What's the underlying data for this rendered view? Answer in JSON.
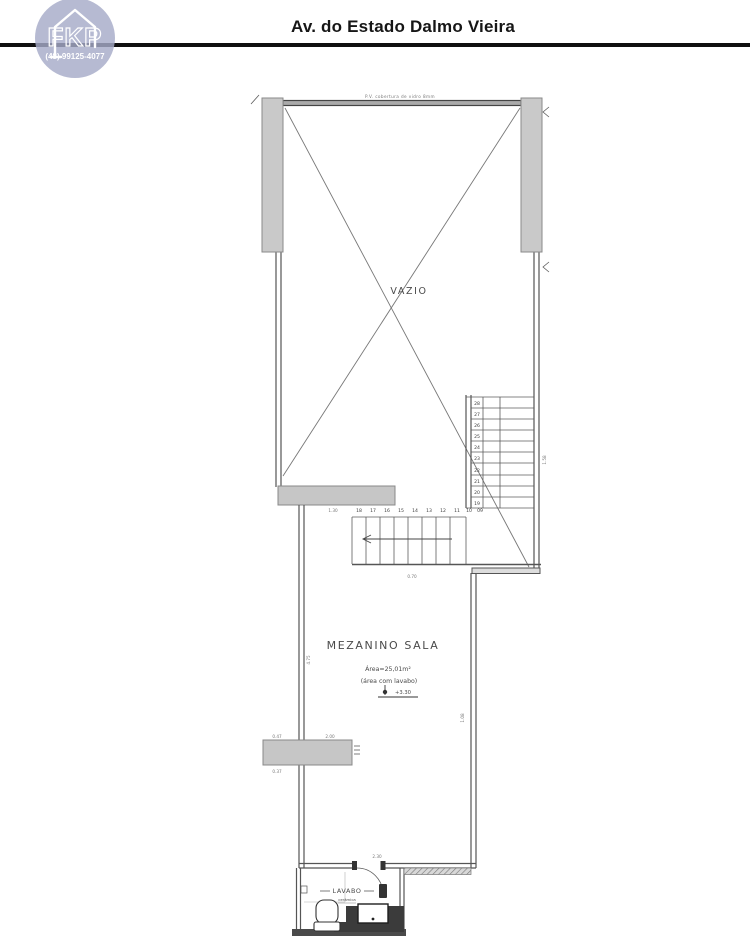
{
  "header": {
    "title": "Av. do Estado Dalmo Vieira",
    "logo": {
      "text": "FKP",
      "phone": "(48) 99125-4077",
      "color": "#a6abc8"
    }
  },
  "plan": {
    "labels": {
      "top_note": "P.V. cobertura de vidro 8mm",
      "vazio": "VAZIO",
      "room": "MEZANINO SALA",
      "area": "Área=25,01m²",
      "area_note": "(área com lavabo)",
      "level": "+3.30",
      "lavabo": "LAVABO",
      "lavabo_note": "cerâmica"
    },
    "dims": {
      "stair_run": "1.30",
      "stair_bottom": "0.70",
      "door": "2.30",
      "sill_top_left": "0.47",
      "sill_top_right": "2.00",
      "sill_bottom_left": "0.37",
      "right_wall": "1.58",
      "mezz_right_wall": "1.08",
      "mezz_left_wall": "4.75"
    },
    "stairs": {
      "vertical": [
        "28",
        "27",
        "26",
        "25",
        "24",
        "23",
        "22",
        "21",
        "20",
        "19"
      ],
      "horizontal": [
        "18",
        "17",
        "16",
        "15",
        "14",
        "13",
        "12",
        "11",
        "10",
        "09"
      ]
    }
  }
}
